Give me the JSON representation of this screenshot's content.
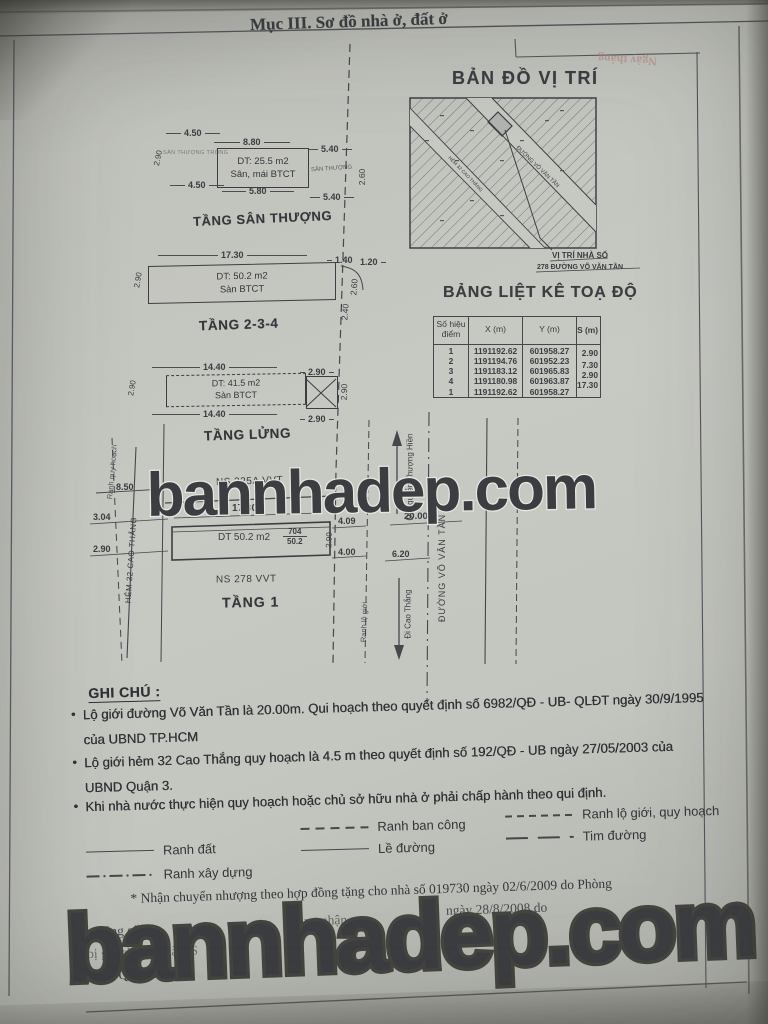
{
  "header": {
    "title": "Mục III. Sơ đồ nhà ở, đất ở"
  },
  "bleedthrough": {
    "note": "Ngày tháng"
  },
  "map": {
    "title": "BẢN ĐỒ VỊ TRÍ",
    "road_label": "ĐƯỜNG VÕ VĂN TẦN",
    "alley_label": "HẺM 32 CAO THẮNG",
    "caption_line1": "VỊ TRÍ NHÀ SỐ",
    "caption_line2": "278 ĐƯỜNG VÕ VĂN TẦN"
  },
  "coord_table": {
    "title": "BẢNG LIỆT KÊ TOẠ ĐỘ",
    "col_point_l1": "Số hiệu",
    "col_point_l2": "điểm",
    "col_x": "X (m)",
    "col_y": "Y (m)",
    "col_s": "S (m)",
    "rows": [
      {
        "id": "1",
        "x": "1191192.62",
        "y": "601958.27"
      },
      {
        "id": "2",
        "x": "1191194.76",
        "y": "601952.23"
      },
      {
        "id": "3",
        "x": "1191183.12",
        "y": "601965.83"
      },
      {
        "id": "4",
        "x": "1191180.98",
        "y": "601963.87"
      },
      {
        "id": "1",
        "x": "1191192.62",
        "y": "601958.27"
      }
    ],
    "s_values": [
      "2.90",
      "7.30",
      "2.90",
      "17.30"
    ]
  },
  "floor_roof": {
    "label": "TẦNG SÂN THƯỢNG",
    "area": "DT: 25.5 m2",
    "material": "Sân, mái BTCT",
    "note_left": "SÂN THƯỢNG TRỐNG",
    "note_right": "SÂN THƯỢNG",
    "dim_top_left": "4.50",
    "dim_top_mid": "8.80",
    "dim_top_right": "5.40",
    "dim_bottom_left": "4.50",
    "dim_bottom_mid": "5.80",
    "dim_bottom_right": "5.40",
    "dim_left": "2.90",
    "dim_right": "2.60"
  },
  "floor_234": {
    "label": "TẦNG 2-3-4",
    "area": "DT: 50.2 m2",
    "material": "Sàn BTCT",
    "dim_top": "17.30",
    "dim_left": "2.90",
    "dim_r_top1": "1.40",
    "dim_r_top2": "1.20",
    "dim_r_mid": "2.60",
    "dim_r_bot": "2.40"
  },
  "floor_mezz": {
    "label": "TẦNG LỬNG",
    "area": "DT: 41.5 m2",
    "material": "Sàn BTCT",
    "dim_top": "14.40",
    "dim_top_right": "2.90",
    "dim_bottom": "14.40",
    "dim_bottom_right": "2.90",
    "dim_left": "2.90",
    "dim_right": "2.90"
  },
  "floor_1": {
    "label": "TẦNG 1",
    "ns_top": "NS 325A VVT",
    "ns_bottom": "NS 278 VVT",
    "area": "DT 50.2 m2",
    "parcel_number": "704",
    "parcel_area": "50.2",
    "dim_width": "17.30",
    "dim_8_50": "8.50",
    "dim_3_04": "3.04",
    "dim_2_90_left": "2.90",
    "dim_2_90_right": "2.90",
    "dim_4_09": "4.09",
    "dim_4_00": "4.00",
    "dim_6_20": "6.20",
    "dim_20_00": "20.00",
    "alley_label": "HẺM 32 CAO THẮNG",
    "street_label": "ĐƯỜNG VÕ VĂN TẦN",
    "dir_north": "Đi Nguyễn Thượng Hiền",
    "dir_south": "Đi Cao Thắng",
    "planning_boundary": "Ranh quy hoạch",
    "setback_boundary": "Ranh lộ giới"
  },
  "notes": {
    "title": "GHI CHÚ :",
    "b1_l1": "Lộ giới đường Võ Văn Tần là 20.00m. Qui hoạch theo  quyết định số 6982/QĐ - UB- QLĐT ngày 30/9/1995",
    "b1_l2": "của UBND TP.HCM",
    "b2_l1": "Lộ giới hẻm 32 Cao Thắng quy hoạch là 4.5 m theo  quyết định số 192/QĐ - UB ngày  27/05/2003 của",
    "b2_l2": "UBND Quận 3.",
    "b3": "Khi nhà nước thực hiện quy hoạch hoặc chủ sở hữu nhà ở phải chấp hành theo qui định.",
    "bullet": "●"
  },
  "legend": {
    "ranh_dat": "Ranh đất",
    "ranh_xay_dung": "Ranh xây dựng",
    "ranh_ban_cong": "Ranh ban công",
    "le_duong": "Lề đường",
    "ranh_lo_gioi": "Ranh lộ giới, quy hoạch",
    "tim_duong": "Tim đường"
  },
  "footer": {
    "line1": "* Nhận chuyển nhượng theo hợp đồng tặng cho nhà số 019730 ngày 02/6/2009 do Phòng",
    "frag1": "ôn chứng số",
    "frag2": "bằng nhận",
    "frag3": "ngày 28/8/2008 do",
    "frag4": "bị giá chứng nhà QS",
    "line_last": "UBND Quận 3 cấp."
  },
  "watermark": {
    "text": "bannhadep.com"
  }
}
